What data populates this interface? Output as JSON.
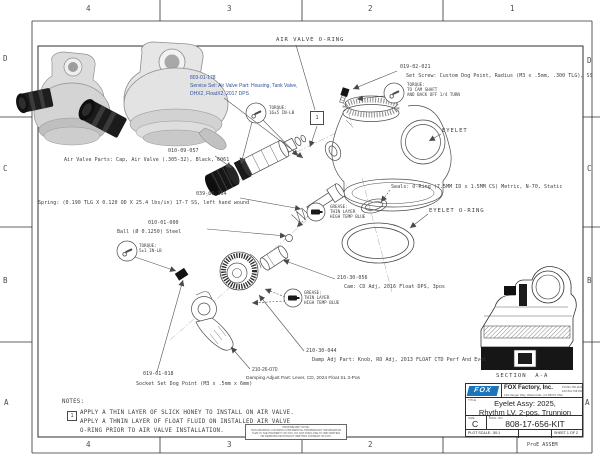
{
  "sheet": {
    "cols_top": [
      "4",
      "3",
      "2",
      "1"
    ],
    "cols_bottom": [
      "4",
      "3",
      "2"
    ],
    "rows_left": [
      "D",
      "C",
      "B",
      "A"
    ],
    "rows_right": [
      "D",
      "C",
      "B",
      "A"
    ],
    "footer_right": "ProE ASSEM"
  },
  "labels": {
    "air_valve_oring": "AIR VALVE O-RING",
    "eyelet": "EYELET",
    "eyelet_oring": "EYELET O-RING",
    "note_flag": "1"
  },
  "parts": {
    "service_set": {
      "pn": "803-01-178",
      "desc1": "Service Set: Air Valve Part: Housing, Tank Valve,",
      "desc2": "DHX2, FloatX2, 2017 DPS"
    },
    "set_screw": {
      "pn": "019-02-021",
      "desc": "Set Screw: Custom Dog Point, Radius (M3 x .5mm, .300 TLG), SS"
    },
    "air_valve_cap": {
      "pn": "010-09-057",
      "desc": "Air Valve Parts: Cap, Air Valve (.305-32), Black, 6061"
    },
    "spring": {
      "pn": "039-00-264",
      "desc": "Spring: (0.190 TLG X 0.120 OD X 25.4 lbs/in) 17-7 SS, left hand wound"
    },
    "ball": {
      "pn": "010-01-000",
      "desc": "Ball (Ø 0.1250) Steel"
    },
    "seals": {
      "desc": "Seals: O-Ring (7.5MM ID x 1.5MM CS) Metric, N-70, Static"
    },
    "cam": {
      "pn": "210-30-056",
      "desc": "Cam: CD Adj, 2016 Float DPS, 3pos"
    },
    "knob": {
      "pn": "210-30-044",
      "desc": "Damp Adj Part: Knob, RD Adj, 2013 FLOAT CTD Perf And Evol"
    },
    "lever": {
      "pn": "210-26-070",
      "desc": "Damping Adjust Part: Lever, CD, 2024 Float SL 3-Pos"
    },
    "socket_set": {
      "pn": "019-01-018",
      "desc": "Socket Set Dog Point (M3 x .5mm x 6mm)"
    }
  },
  "torque_notes": {
    "t1": {
      "l1": "TORQUE:",
      "l2": "16±5 IN-LB"
    },
    "t2": {
      "l1": "TORQUE:",
      "l2": "TO CAM SHAFT",
      "l3": "AND BACK OFF 1/4 TURN"
    },
    "t3": {
      "l1": "TORQUE:",
      "l2": "5±1 IN-LB"
    }
  },
  "grease_note": {
    "l1": "GREASE:",
    "l2": "THIN LAYER",
    "l3": "HIGH TEMP BLUE"
  },
  "notes": {
    "heading": "NOTES:",
    "flag": "1",
    "line1": "APPLY A THIN LAYER OF SLICK HONEY TO INSTALL ON AIR VALVE.",
    "line2": "APPLY A THNIN LAYER OF FLOAT FLUID ON INSTALLED AIR VALVE",
    "line3": "O-RING PRIOR TO AIR VALVE INSTALLATION."
  },
  "section": {
    "label": "SECTION  A-A"
  },
  "title_block": {
    "logo": "FOX",
    "company": "FOX Factory, Inc.",
    "address": "130 Hangar Way, Watsonville, CA 95076 USA",
    "phone": "PH 831-768-1100",
    "fax": "FAX 831-768-9342",
    "title_label": "TITLE",
    "title_line1": "Eyelet Assy: 2025,",
    "title_line2": "Rhythm LV, 2-pos, Trunnion",
    "size_label": "SIZE",
    "size": "C",
    "dwg_label": "DWG. NO.",
    "dwg_no": "808-17-656-KIT",
    "scale": "PLOT SCALE: .50:1",
    "sheet": "SHEET 1 OF 2"
  },
  "proprietary": {
    "l1": "PROPRIETARY NOTE:",
    "l2": "THIS DRAWING CONTAINS CONFIDENTIAL PROPRIETARY INFORMATION",
    "l3": "THAT IS THE PROPERTY OF FOX. DO NOT DISCLOSE TO 3RD PARTIES",
    "l4": "OR REPRODUCE WITHOUT WRITTEN CONSENT OF FOX."
  },
  "colors": {
    "accent_blue": "#31519c",
    "logo_blue": "#1b75bb",
    "line": "#3d3d3d"
  }
}
